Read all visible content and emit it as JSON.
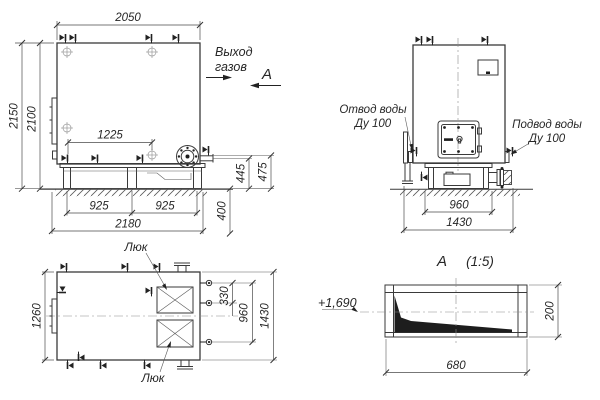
{
  "front_view": {
    "dim_width_top": "2050",
    "dim_height_overall": "2150",
    "dim_height_body": "2100",
    "dim_valves_span": "1225",
    "dim_base_left": "925",
    "dim_base_right": "925",
    "dim_base_overall": "2180",
    "dim_nozzle_height": "445",
    "dim_flange_height": "475",
    "dim_base_height": "400",
    "gas_outlet_line1": "Выход",
    "gas_outlet_line2": "газов",
    "section_mark": "А"
  },
  "side_view": {
    "water_outlet_line1": "Отвод воды",
    "water_outlet_line2": "Ду 100",
    "water_inlet_line1": "Подвод воды",
    "water_inlet_line2": "Ду 100",
    "dim_base_width": "960",
    "dim_overall_width": "1430"
  },
  "plan_view": {
    "hatch_label_top": "Люк",
    "hatch_label_bottom": "Люк",
    "dim_body_width": "1260",
    "dim_nozzle_offset": "330",
    "dim_nozzle_span": "960",
    "dim_overall_width": "1430"
  },
  "section_view": {
    "label": "А",
    "scale": "(1:5)",
    "elevation_mark": "+1,690",
    "dim_length": "680",
    "dim_height": "200"
  },
  "colors": {
    "line": "#3a3a3a",
    "solid_fill": "#1d1d1d",
    "background": "#ffffff"
  }
}
